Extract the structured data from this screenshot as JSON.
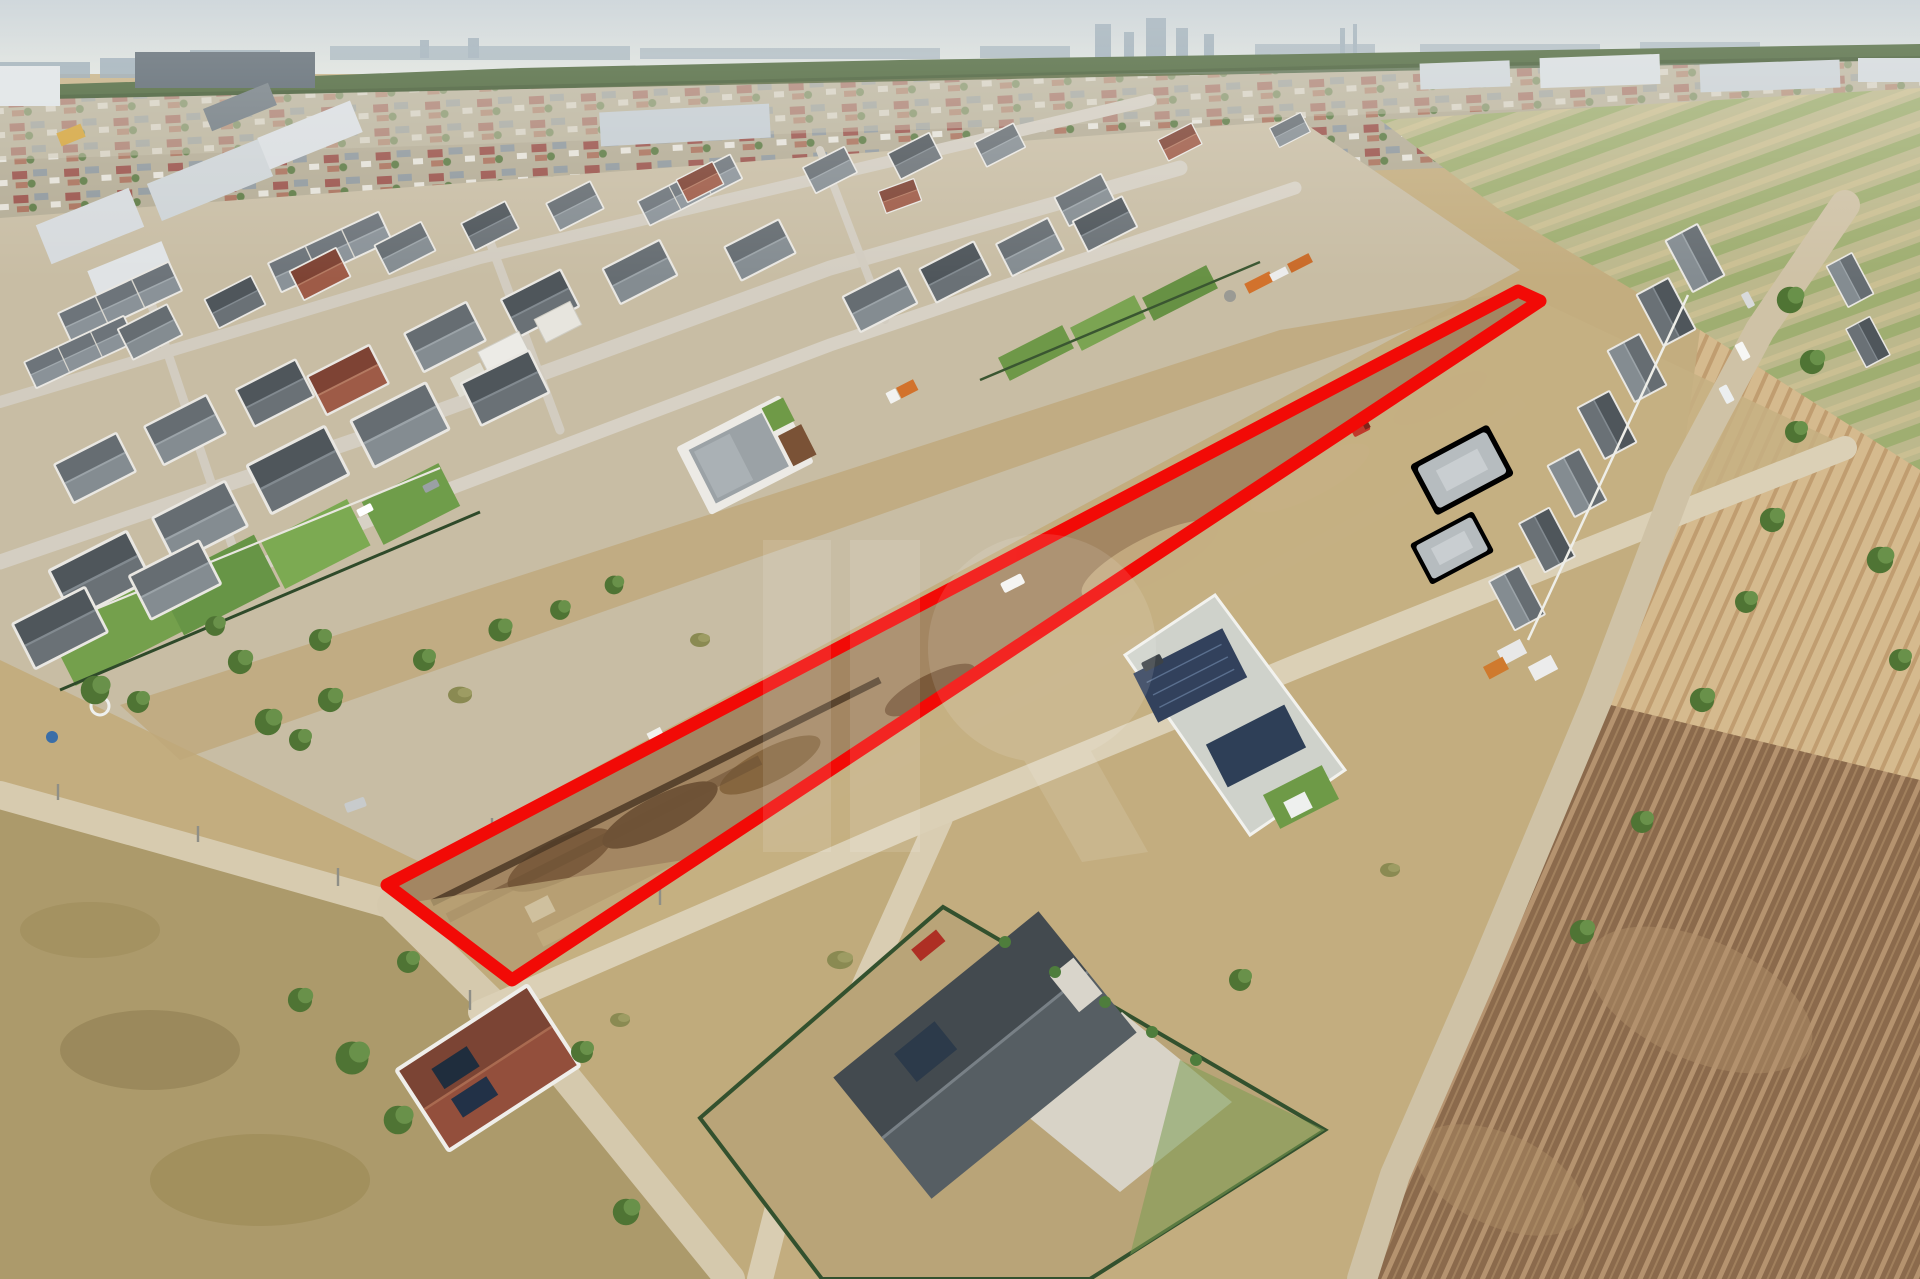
{
  "meta": {
    "kind": "aerial-drone-photograph",
    "subject": "suburban residential development with vacant land plot marked for sale",
    "width": 1920,
    "height": 1279,
    "visible_text": ""
  },
  "annotations": {
    "plot_outline": {
      "shape": "quadrilateral",
      "color": "#f20a06",
      "stroke_width": 13,
      "points": "387,885 1518,291 1540,301 512,980"
    },
    "watermark": {
      "kind": "agency-logo-monogram",
      "color": "#ffffff",
      "opacity": 0.11
    }
  },
  "palette": {
    "sky": "#c3cdd2",
    "haze": "#dadfdc",
    "forest": "#466033",
    "distant_suburb": "#b3ab94",
    "ground": "#c3ad7f",
    "dry_grass": "#ac9a6b",
    "dirt_plot": "#a38662",
    "trench": "#4c3826",
    "road": "#d7cbaf",
    "tan_field": "#d5ba8e",
    "plowed_field": "#8b6a4c",
    "roof_dark": "#4f565b",
    "roof_grey": "#666d72",
    "roof_red": "#7e4334",
    "wall_white": "#eceae5",
    "lawn": "#74a04c",
    "tree": "#4f7434",
    "solar_panel": "#2f415c",
    "red_car": "#ae2f24"
  }
}
